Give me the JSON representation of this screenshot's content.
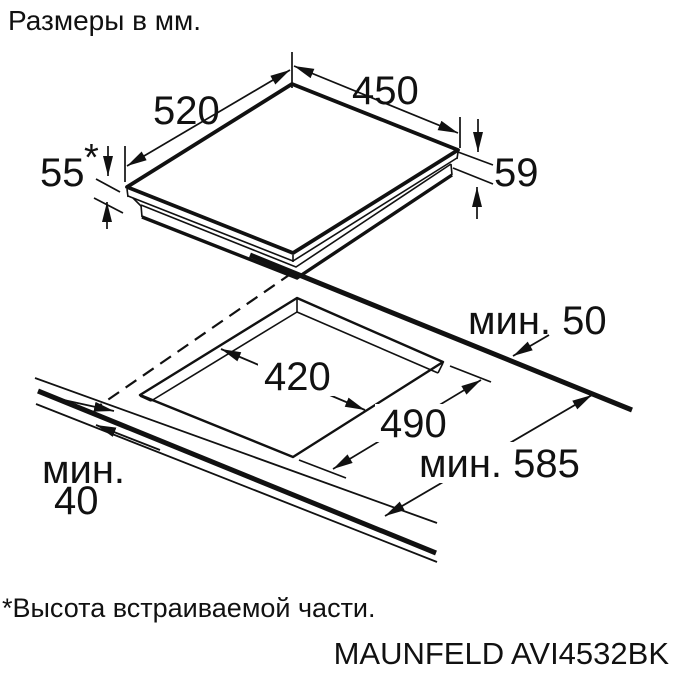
{
  "title": "Размеры в мм.",
  "footnote": "*Высота встраиваемой части.",
  "model": "MAUNFELD AVI4532BK",
  "colors": {
    "line": "#111111",
    "background": "#ffffff"
  },
  "hob": {
    "depth_label": "520",
    "width_label": "450",
    "height_left_label": "55",
    "height_left_mark": "*",
    "height_right_label": "59"
  },
  "cutout": {
    "width_label": "420",
    "depth_label": "490",
    "min_back_clearance_label": "мин. 50",
    "min_worktop_depth_label": "мин. 585",
    "min_front_word": "мин.",
    "min_front_value": "40"
  }
}
